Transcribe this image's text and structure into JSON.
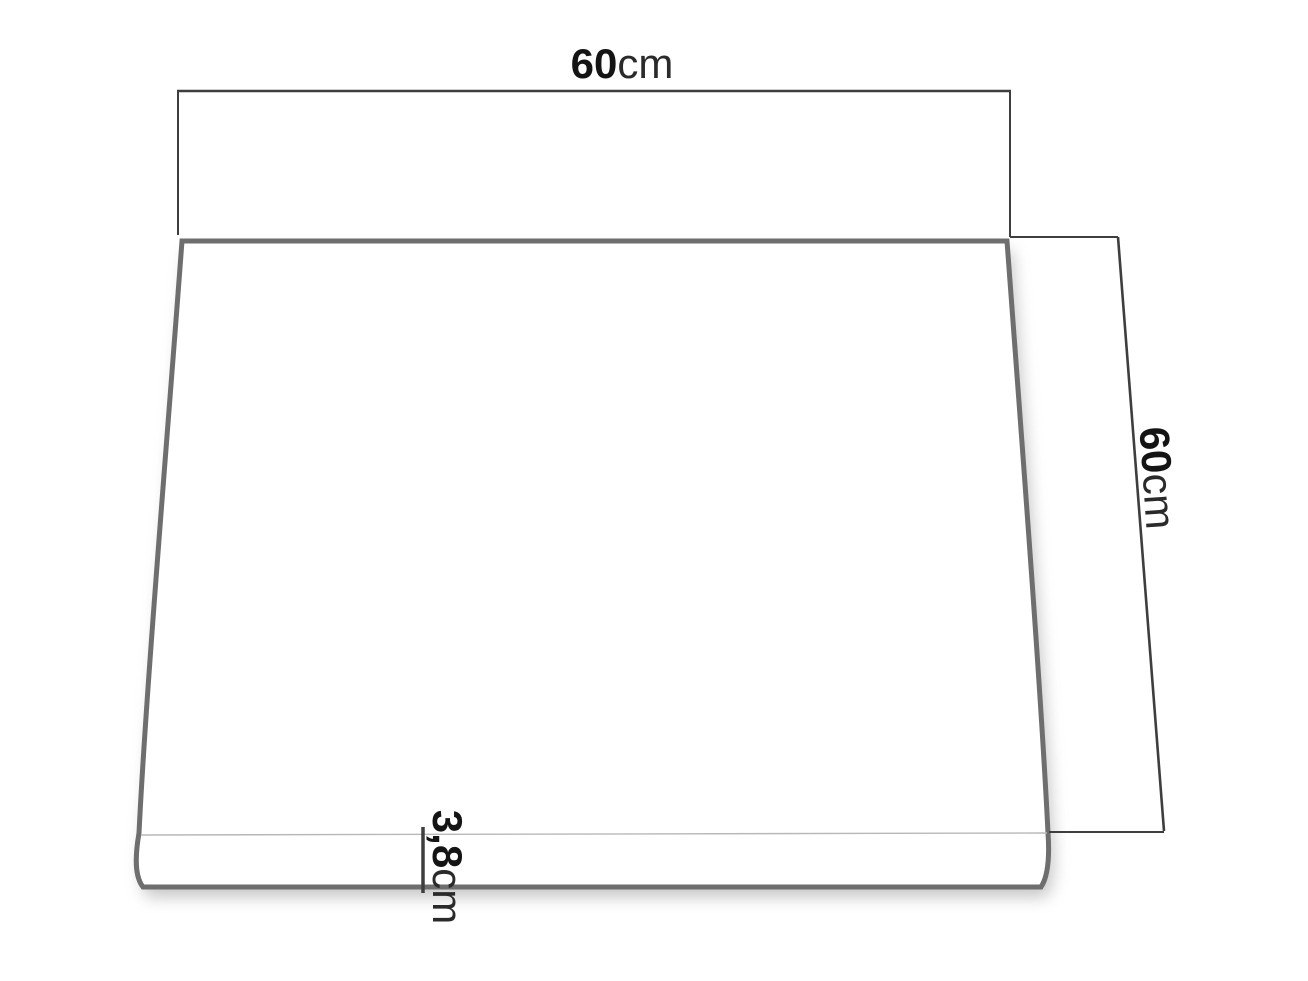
{
  "diagram": {
    "name": "seat-cushion-dimension-drawing",
    "object": "square seat cushion, perspective top view",
    "dimensions": {
      "top_width": {
        "value": "60",
        "unit": "cm"
      },
      "side_depth": {
        "value": "60",
        "unit": "cm"
      },
      "thickness": {
        "value": "3,8",
        "unit": "cm"
      }
    },
    "colors": {
      "background": "#ffffff",
      "cushion_outline": "#6e6e6e",
      "dimension_line": "#3e3e3e",
      "seam_line": "#b8b8b8",
      "label_text": "#1b1b1b",
      "shadow": "#8c8c8c"
    }
  }
}
